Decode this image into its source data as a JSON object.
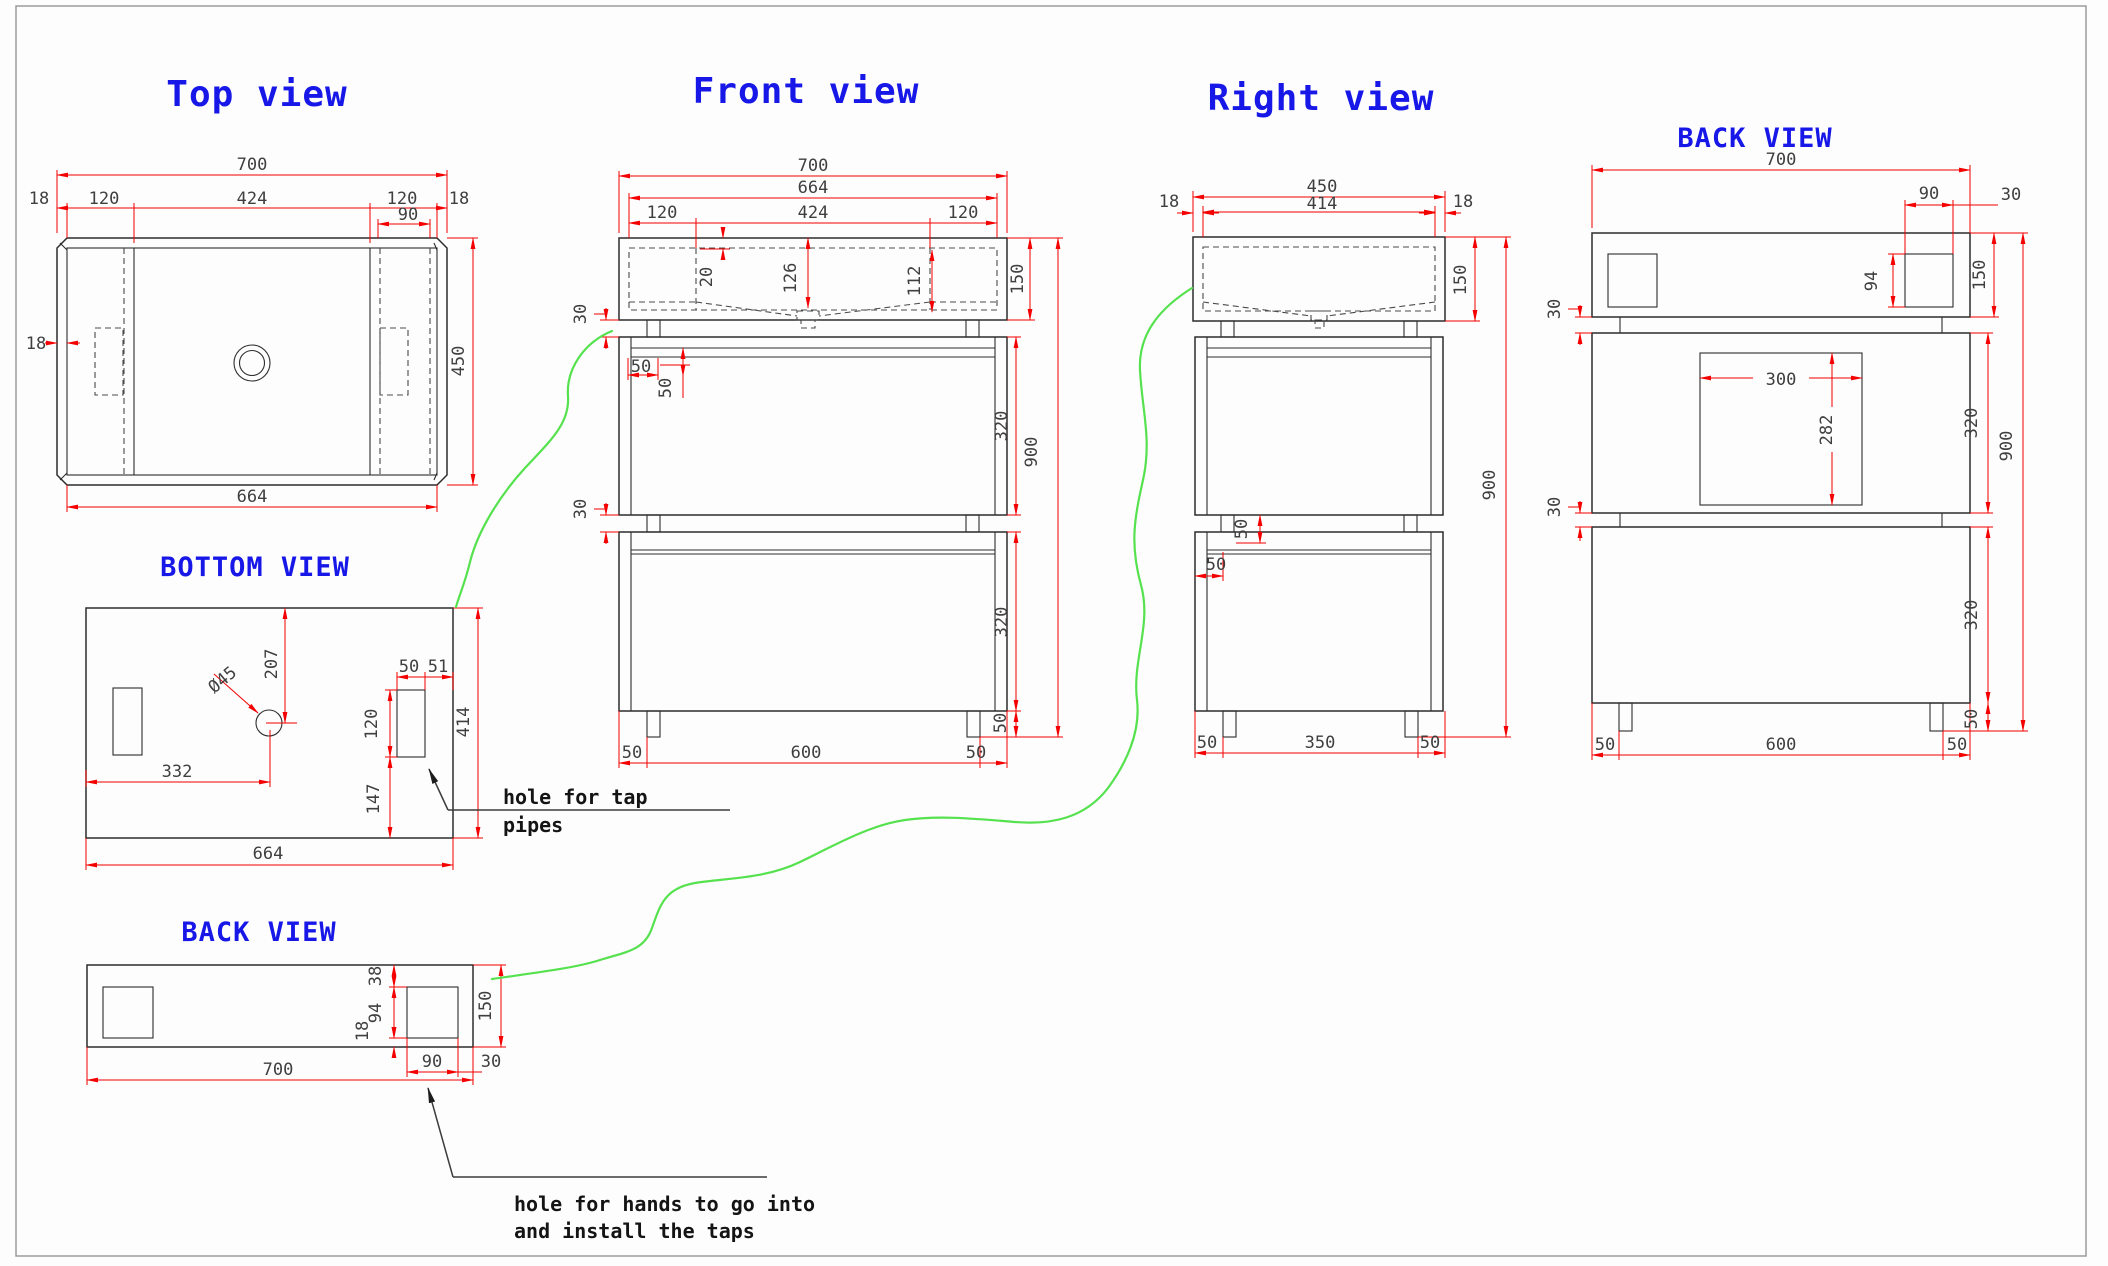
{
  "colors": {
    "title_blue": "#1717e8",
    "dim_red": "#f40000",
    "line_dark": "#2d2d2d",
    "hidden_line": "#4a4a4a",
    "dim_text": "#3f3f3f",
    "leader_green": "#55e24e",
    "note_black": "#141414",
    "page_border": "#9b9b9b",
    "background": "#fdfdfd"
  },
  "views": {
    "top": {
      "title": "Top view",
      "dims": {
        "overall_width": "700",
        "edge_left": "18",
        "inset_left": "120",
        "center_span": "424",
        "inset_right": "120",
        "edge_right": "18",
        "hand_hole_width": "90",
        "wall_thickness": "18",
        "depth": "450",
        "inner_width": "664"
      }
    },
    "front": {
      "title": "Front view",
      "dims": {
        "overall_width": "700",
        "top_inner_width": "664",
        "basin_left": "120",
        "basin_span": "424",
        "basin_right": "120",
        "rim_depth": "20",
        "drain_depth": "126",
        "basin_inner_depth": "112",
        "top_height": "150",
        "gap_upper": "30",
        "gap_lower": "30",
        "rail_width": "50",
        "rail_height": "50",
        "drawer_upper": "320",
        "drawer_lower": "320",
        "foot_height": "50",
        "overall_height": "900",
        "foot_inset_left": "50",
        "foot_span": "600",
        "foot_inset_right": "50"
      }
    },
    "right": {
      "title": "Right view",
      "dims": {
        "overall_depth": "450",
        "inner_depth": "414",
        "wall_left": "18",
        "wall_right": "18",
        "top_height": "150",
        "overall_height": "900",
        "rail_height": "50",
        "rail_width": "50",
        "foot_inset_left": "50",
        "foot_span": "350",
        "foot_inset_right": "50"
      }
    },
    "back_top": {
      "title": "BACK VIEW",
      "dims": {
        "overall_width": "700",
        "hand_hole_width": "90",
        "hand_hole_edge": "30",
        "hand_hole_height": "94",
        "top_height": "150",
        "opening_width": "300",
        "opening_height": "282",
        "gap_upper": "30",
        "gap_lower": "30",
        "drawer_upper": "320",
        "drawer_lower": "320",
        "foot_height": "50",
        "overall_height": "900",
        "foot_inset_left": "50",
        "foot_span": "600",
        "foot_inset_right": "50"
      }
    },
    "bottom": {
      "title": "BOTTOM VIEW",
      "dims": {
        "drain_from_top": "207",
        "drain_diameter": "Ø45",
        "drain_from_left": "332",
        "slot_width": "50",
        "slot_to_edge": "51",
        "slot_height": "120",
        "slot_to_bottom": "147",
        "depth": "414",
        "width": "664"
      },
      "annotation": {
        "line1": "hole for tap",
        "line2": "pipes"
      }
    },
    "back_bottom": {
      "title": "BACK VIEW",
      "dims": {
        "hole_from_top": "38",
        "hole_height": "94",
        "hole_from_bottom": "18",
        "panel_height": "150",
        "hole_width": "90",
        "hole_to_edge": "30",
        "overall_width": "700"
      },
      "annotation": {
        "line1": "hole for hands to go into",
        "line2": "and install the taps"
      }
    }
  }
}
